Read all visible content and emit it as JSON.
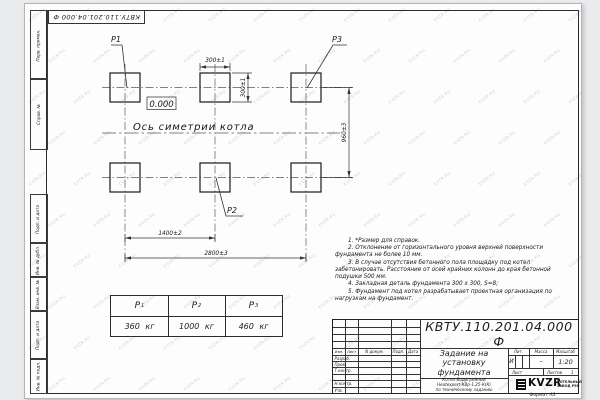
{
  "sheet": {
    "doc_number_stamp": "КВТУ.110.201.04.000 Ф",
    "format_label": "Формат А3"
  },
  "side_column": {
    "top_cells": [
      "Перв. примен.",
      "Справ. №"
    ],
    "bottom_cells": [
      "Подп. и дата",
      "Инв. № дубл.",
      "Взам. инв. №",
      "Подп. и дата",
      "Инв. № подл."
    ]
  },
  "drawing": {
    "labels": {
      "p1": "P1",
      "p2": "P2",
      "p3": "P3"
    },
    "elevation": "0.000",
    "axis_caption": "Ось симетрии котла",
    "dims": {
      "w300": "300±1",
      "h300": "300±1",
      "v960": "960±3",
      "w1400": "1400±2",
      "w2800": "2800±3"
    }
  },
  "load_table": {
    "headers": [
      {
        "base": "P",
        "sub": "1"
      },
      {
        "base": "P",
        "sub": "2"
      },
      {
        "base": "P",
        "sub": "3"
      }
    ],
    "values": [
      "360 кг",
      "1000 кг",
      "460 кг"
    ]
  },
  "notes": [
    "1. *Размер для справок.",
    "2. Отклонение от горизонтального уровня верхней поверхности фундамента не более 10 мм.",
    "3. В случае отсутствия бетонного пола площадку под котел забетонировать. Расстояние от осей крайних колонн до края бетонной подушки 500 мм.",
    "4. Закладная деталь фундамента 300 x 300, S=8;",
    "5. Фундамент под котел разрабатывает проектная организация по нагрузкам на фундамент."
  ],
  "title_block": {
    "doc_number": "КВТУ.110.201.04.000  Ф",
    "title_lines": [
      "Задание на",
      "установку",
      "фундамента"
    ],
    "subtitle_lines": [
      "Котел Водогрейный",
      "Heatexpert-КВр-1,25-К(К)",
      "по техническому заданию"
    ],
    "header_row": [
      "Изм.",
      "Лист",
      "N докум.",
      "Подп.",
      "Дата"
    ],
    "sign_rows": [
      "Разраб.",
      "Пров.",
      "Т.контр.",
      "",
      "Н.контр.",
      "Утв."
    ],
    "lit_header": [
      "Лит.",
      "Масса",
      "Масштаб"
    ],
    "lit_value": "И",
    "mass_value": "–",
    "scale_value": "1:20",
    "sheet_row": {
      "list_label": "Лист",
      "listov_label": "Листов",
      "listov_value": "1"
    },
    "logo_text": "KVZR",
    "logo_caption_lines": [
      "КОТЕЛЬНЫЙ",
      "ЗАВОД РЭП"
    ]
  },
  "watermark": {
    "text": "KVZR.RU"
  },
  "colors": {
    "line": "#2b2b2b",
    "watermark": "#93a7ba",
    "sheet": "#fdfdfd"
  }
}
